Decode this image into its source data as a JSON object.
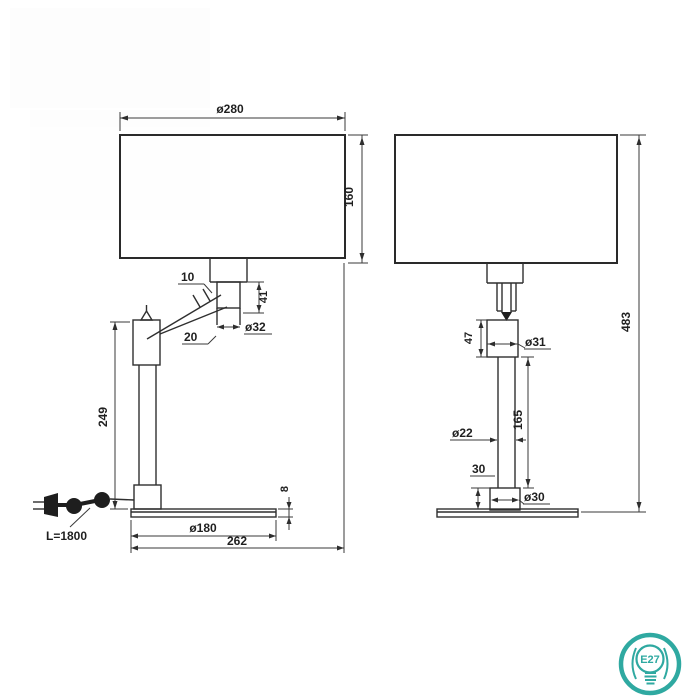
{
  "front_view": {
    "shade_diameter": "ø280",
    "shade_height": "160",
    "arm_joint_offset": "10",
    "socket_block_height": "41",
    "socket_diameter": "ø32",
    "arm_tube_width": "20",
    "column_height": "249",
    "cord_length": "L=1800",
    "base_diameter": "ø180",
    "overall_width": "262",
    "base_thickness": "8"
  },
  "side_view": {
    "holder_height": "47",
    "holder_diameter": "ø31",
    "column_diameter": "ø22",
    "column_section_height": "165",
    "mount_height": "30",
    "mount_diameter": "ø30",
    "overall_height": "483"
  },
  "badge": {
    "socket_type": "E27"
  },
  "colors": {
    "line": "#2f2f2f",
    "badge_teal": "#2fa9a1",
    "background": "#ffffff"
  }
}
